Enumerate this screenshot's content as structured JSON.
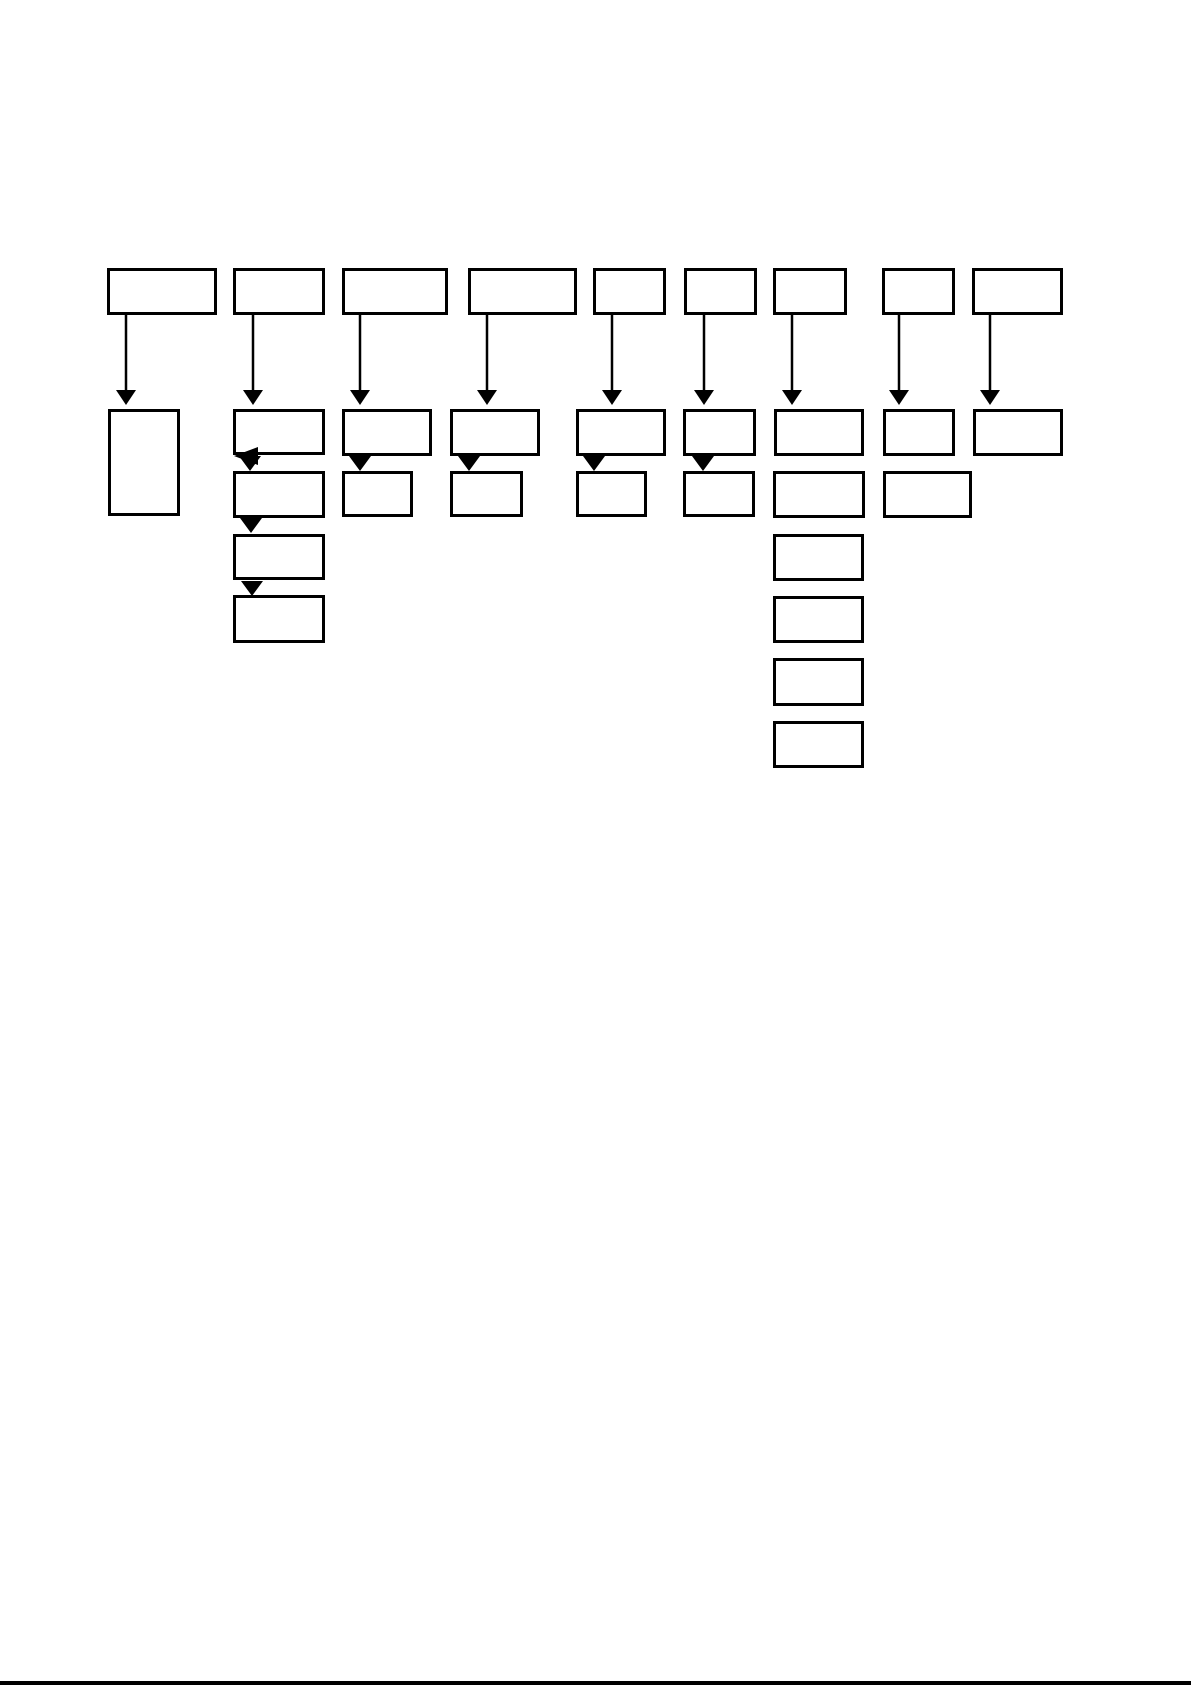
{
  "page": {
    "width": 1191,
    "height": 1685,
    "background_color": "#ffffff",
    "bottom_rule_color": "#000000"
  },
  "diagram": {
    "description": "Flowchart of empty unlabeled boxes: nine top boxes each with a vertical arrow down to a second tier; several columns have stacked child boxes below",
    "stroke_color": "#000000",
    "box_fill_color": "#ffffff",
    "box_border_px": 3,
    "arrow_line_px": 2.5,
    "boxes": [
      {
        "id": "top-box-1",
        "x": 107,
        "y": 268,
        "w": 110,
        "h": 47
      },
      {
        "id": "top-box-2",
        "x": 233,
        "y": 268,
        "w": 92,
        "h": 47
      },
      {
        "id": "top-box-3",
        "x": 342,
        "y": 268,
        "w": 106,
        "h": 47
      },
      {
        "id": "top-box-4",
        "x": 468,
        "y": 268,
        "w": 109,
        "h": 47
      },
      {
        "id": "top-box-5",
        "x": 593,
        "y": 268,
        "w": 73,
        "h": 47
      },
      {
        "id": "top-box-6",
        "x": 684,
        "y": 268,
        "w": 73,
        "h": 47
      },
      {
        "id": "top-box-7",
        "x": 773,
        "y": 268,
        "w": 74,
        "h": 47
      },
      {
        "id": "top-box-8",
        "x": 882,
        "y": 268,
        "w": 73,
        "h": 47
      },
      {
        "id": "top-box-9",
        "x": 972,
        "y": 268,
        "w": 91,
        "h": 47
      },
      {
        "id": "col1-tall-box",
        "x": 108,
        "y": 409,
        "w": 72,
        "h": 107
      },
      {
        "id": "col2-box-a",
        "x": 233,
        "y": 409,
        "w": 92,
        "h": 46
      },
      {
        "id": "col3-box-a",
        "x": 342,
        "y": 409,
        "w": 90,
        "h": 47
      },
      {
        "id": "col4-box-a",
        "x": 450,
        "y": 409,
        "w": 90,
        "h": 47
      },
      {
        "id": "col5-box-a",
        "x": 576,
        "y": 409,
        "w": 90,
        "h": 47
      },
      {
        "id": "col6-box-a",
        "x": 683,
        "y": 409,
        "w": 73,
        "h": 47
      },
      {
        "id": "col7-box-a",
        "x": 774,
        "y": 409,
        "w": 90,
        "h": 47
      },
      {
        "id": "col8-box-a",
        "x": 883,
        "y": 409,
        "w": 72,
        "h": 47
      },
      {
        "id": "col9-box-a",
        "x": 973,
        "y": 409,
        "w": 90,
        "h": 47
      },
      {
        "id": "col2-box-b",
        "x": 233,
        "y": 471,
        "w": 92,
        "h": 47
      },
      {
        "id": "col3-box-b",
        "x": 342,
        "y": 471,
        "w": 71,
        "h": 46
      },
      {
        "id": "col4-box-b",
        "x": 450,
        "y": 471,
        "w": 73,
        "h": 46
      },
      {
        "id": "col5-box-b",
        "x": 576,
        "y": 471,
        "w": 71,
        "h": 46
      },
      {
        "id": "col6-box-b",
        "x": 683,
        "y": 471,
        "w": 72,
        "h": 46
      },
      {
        "id": "col7-box-b",
        "x": 773,
        "y": 471,
        "w": 92,
        "h": 47
      },
      {
        "id": "col8-box-b",
        "x": 883,
        "y": 471,
        "w": 89,
        "h": 47
      },
      {
        "id": "col2-box-c",
        "x": 233,
        "y": 534,
        "w": 92,
        "h": 46
      },
      {
        "id": "col2-box-d",
        "x": 233,
        "y": 595,
        "w": 92,
        "h": 48
      },
      {
        "id": "col7-box-c",
        "x": 773,
        "y": 534,
        "w": 91,
        "h": 47
      },
      {
        "id": "col7-box-d",
        "x": 773,
        "y": 596,
        "w": 91,
        "h": 47
      },
      {
        "id": "col7-box-e",
        "x": 773,
        "y": 658,
        "w": 91,
        "h": 48
      },
      {
        "id": "col7-box-f",
        "x": 773,
        "y": 721,
        "w": 91,
        "h": 47
      }
    ],
    "connector_arrows": [
      {
        "id": "arrow-col1",
        "x": 126,
        "y1": 315,
        "y2": 390
      },
      {
        "id": "arrow-col2",
        "x": 253,
        "y1": 315,
        "y2": 390
      },
      {
        "id": "arrow-col3",
        "x": 360,
        "y1": 315,
        "y2": 390
      },
      {
        "id": "arrow-col4",
        "x": 487,
        "y1": 315,
        "y2": 390
      },
      {
        "id": "arrow-col5",
        "x": 612,
        "y1": 315,
        "y2": 390
      },
      {
        "id": "arrow-col6",
        "x": 704,
        "y1": 315,
        "y2": 390
      },
      {
        "id": "arrow-col7",
        "x": 792,
        "y1": 315,
        "y2": 390
      },
      {
        "id": "arrow-col8",
        "x": 899,
        "y1": 315,
        "y2": 390
      },
      {
        "id": "arrow-col9",
        "x": 990,
        "y1": 315,
        "y2": 390
      }
    ],
    "arrow_head": {
      "width": 20,
      "height": 15
    },
    "down_arrowheads": [
      {
        "id": "head-col3-a-b",
        "cx": 360,
        "y": 456
      },
      {
        "id": "head-col4-a-b",
        "cx": 469,
        "y": 456
      },
      {
        "id": "head-col5-a-b",
        "cx": 594,
        "y": 456
      },
      {
        "id": "head-col6-a-b",
        "cx": 703,
        "y": 456
      },
      {
        "id": "head-col2-a-b",
        "cx": 250,
        "y": 456
      },
      {
        "id": "head-col2-b-c",
        "cx": 251,
        "y": 518
      },
      {
        "id": "head-col2-c-d",
        "cx": 252,
        "y": 581
      }
    ],
    "left_arrowhead": {
      "id": "head-col2-bend-left",
      "tip_x": 234,
      "tip_y": 456,
      "base_x": 258,
      "half_height": 9
    }
  }
}
